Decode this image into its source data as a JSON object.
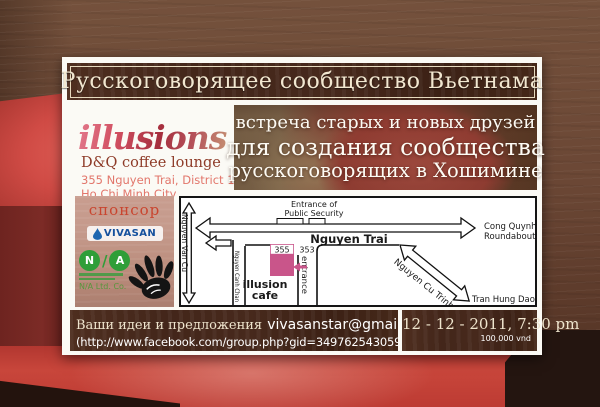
{
  "banner": {
    "title": "Русскоговорящее сообщество Вьетнама"
  },
  "venue": {
    "logo": "illusions",
    "subtitle": "D&Q coffee lounge",
    "address_line1": "355 Nguyen Trai, District 1",
    "address_line2": "Ho Chi Minh City"
  },
  "tagline": {
    "line1": "встреча старых и новых друзей",
    "line2": "для создания сообщества",
    "line3": "русскоговорящих в Хошимине"
  },
  "sponsor": {
    "label": "спонсор",
    "vivasan": "VIVASAN",
    "na_letter_n": "N",
    "na_letter_a": "A",
    "na_slash": "/",
    "na_company": "N/A Ltd. Co."
  },
  "map": {
    "entrance_security_line1": "Entrance of",
    "entrance_security_line2": "Public Security",
    "street_main": "Nguyen Trai",
    "roundabout_line1": "Cong Quynh",
    "roundabout_line2": "Roundabout",
    "street_left": "Nguyen Van Cu",
    "street_canh_chan": "Nguyen Canh Chan",
    "street_cu_trinh": "Nguyen Cu Trinh",
    "street_bottom": "Tran Hung Dao",
    "building_355": "355",
    "building_353": "353",
    "entrance_label": "entrance",
    "cafe_line1": "illusion",
    "cafe_line2": "cafe"
  },
  "footer": {
    "contact_prefix": "Ваши идеи и предложения",
    "email": "vivasanstar@gmail.com",
    "facebook": "(http://www.facebook.com/group.php?gid=349762543059)",
    "datetime": "12 - 12 - 2011, 7:30 pm",
    "price": "100,000 vnd"
  },
  "colors": {
    "banner_bg": "#47291c",
    "accent_pink": "#c9558a",
    "cafe_pink": "#c43f72",
    "vivasan_blue": "#15509d",
    "na_green": "#2f9e38",
    "cream_text": "#f2e7d0"
  }
}
